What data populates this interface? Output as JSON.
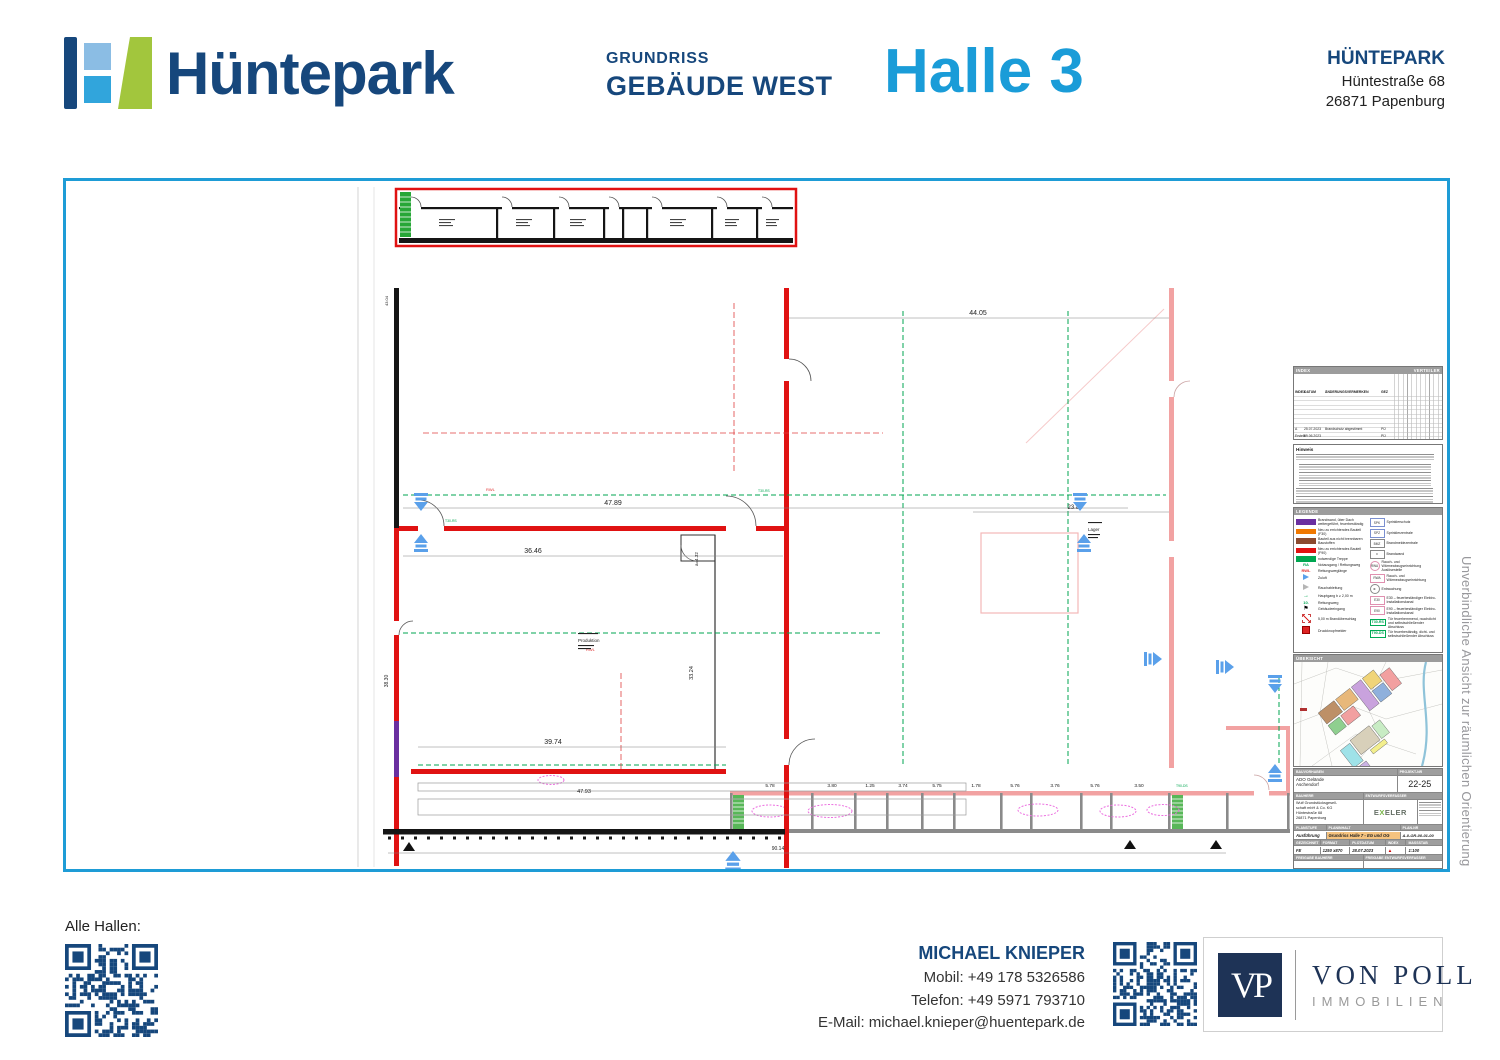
{
  "colors": {
    "brand_navy": "#16477c",
    "accent_blue": "#1a9cd8",
    "frame_blue": "#1e9cd6",
    "wall_red": "#e01212",
    "existing_pink": "#f2a2a2",
    "firewall_purple": "#6a2fa0",
    "escape_green": "#00a651"
  },
  "header": {
    "brand": "Hüntepark",
    "doc_type": "GRUNDRISS",
    "building": "GEBÄUDE WEST",
    "hall_title": "Halle 3",
    "company": "HÜNTEPARK",
    "street": "Hüntestraße 68",
    "city": "26871 Papenburg"
  },
  "side_note": "Unverbindliche Ansicht zur räumlichen Orientierung",
  "plan": {
    "dims": {
      "top": "47.89",
      "right_top": "44.05",
      "hall_width": "36.46",
      "right_mid": "23.86",
      "bottom_inner": "39.74",
      "bottom_outer": "47.93",
      "hall_height": "33.24",
      "left_height": "38.30",
      "gate": "a=4.32",
      "total_bottom": "90.14",
      "top_left": "43.04"
    },
    "strip_dims": [
      "5.78",
      "3.80",
      "1.25",
      "3.74",
      "5.75",
      "1.78",
      "5.76",
      "3.76",
      "5.76",
      "3.50"
    ],
    "rooms": {
      "production": "Produktion",
      "storage": "Lager"
    },
    "marks": {
      "rwl1": "RWL",
      "rwl2": "RWL",
      "door1": "T30-RS",
      "door2": "T30-RS",
      "door3": "T90-DS"
    }
  },
  "revision": {
    "index_header": "INDEX",
    "verteiler_header": "VERTEILER",
    "col_index": "INDEX",
    "col_datum": "DATUM",
    "col_vermerk": "ÄNDERUNGSVERMERKEN",
    "col_gez": "GEZ",
    "row_a": {
      "index": "A",
      "datum": "25.07.2023",
      "vermerk": "Brandschutz abgestimmt",
      "gez": "PÜ"
    },
    "row_erstellt": {
      "index": "Erstellt:",
      "datum": "09.06.2023",
      "vermerk": "",
      "gez": "PÜ"
    }
  },
  "notes": {
    "title": "Hinweis"
  },
  "legend": {
    "title": "LEGENDE",
    "left": [
      {
        "label": "Brandwand, über Dach weitergeführt, feuerbeständig"
      },
      {
        "label": "Neu zu errichtendes Bauteil (F30)"
      },
      {
        "label": "Bauteil aus nicht brennbaren Baustoffen"
      },
      {
        "label": "Neu zu errichtendes Bauteil (F90)"
      },
      {
        "label": "notwendige Treppe"
      },
      {
        "label": "Notausgang / Rettungsweg"
      },
      {
        "label": "Rettungsweglänge"
      },
      {
        "label": "Zuluft"
      },
      {
        "label": "Rauchableitung"
      },
      {
        "label": "Hauptgang b ≥ 2,00 m"
      },
      {
        "label": "Rettungsweg"
      },
      {
        "label": "Gebäudeeingang"
      },
      {
        "label": "5,00 m Brandüberschlag"
      },
      {
        "label": "Druckknopfmelder"
      }
    ],
    "right": [
      {
        "icon": "SPK",
        "label": "Sprinklerschutz"
      },
      {
        "icon": "SPZ",
        "label": "Sprinklerzentrale"
      },
      {
        "icon": "BMZ",
        "label": "Brandmeldezentrale"
      },
      {
        "icon": "≡",
        "label": "Brandwand"
      },
      {
        "icon": "RWA",
        "label": "Rauch- und Wärmeabzugseinrichtung Auslösestelle"
      },
      {
        "icon": "RWA",
        "label": "Rauch- und Wärmeabzugseinrichtung"
      },
      {
        "icon": "⊗",
        "label": "Entrauchung"
      },
      {
        "icon": "E30",
        "label": "E30 – feuerbeständiger Elektro-Installationskanal"
      },
      {
        "icon": "E90",
        "label": "E90 – feuerbeständiger Elektro-Installationskanal"
      },
      {
        "icon": "T30-RS",
        "label": "Tür feuerhemmend, rauchdicht und selbstschließender Abschluss"
      },
      {
        "icon": "T90-DS",
        "label": "Tür feuerbeständig, dicht- und selbstschließender Abschluss"
      }
    ]
  },
  "uebersicht": {
    "title": "ÜBERSICHT"
  },
  "titleblock": {
    "bauvorhaben_label": "BAUVORHABEN",
    "bauvorhaben_1": "ADO Gelände",
    "bauvorhaben_2": "Aschendorf",
    "projekt_label": "PROJEKT-NR",
    "projekt_nr": "22-25",
    "bauherr_label": "BAUHERR",
    "bauherr_1": "Wulf Grundstücksgesell-",
    "bauherr_2": "schaft mbH & Co. KG",
    "bauherr_3": "Hüntestraße 68",
    "bauherr_4": "26871 Papenburg",
    "entwurf_label": "ENTWURFSVERFASSER",
    "entwurf_firm_pre": "E",
    "entwurf_firm_x": "X",
    "entwurf_firm_post": "ELER",
    "planstufe_label": "PLANSTUFE",
    "planstufe": "Ausführung",
    "planinhalt_label": "PLANINHALT",
    "planinhalt": "Grundriss Halle 7 - EG und OG",
    "plannr_label": "PLAN-NR",
    "plannr": "A-0-GR-00-01-00",
    "gezeichnet_label": "GEZEICHNET",
    "gezeichnet": "FE",
    "format_label": "FORMAT",
    "format": "1250 x870",
    "plotdatum_label": "PLOTDATUM",
    "plotdatum": "28.07.2023",
    "index_label": "INDEX",
    "index": "▲",
    "massstab_label": "MASSSTAB",
    "massstab": "1:100",
    "freigabe1_label": "FREIGABE BAUHERR",
    "freigabe2_label": "FREIGABE ENTWURFSVERFASSER"
  },
  "footer": {
    "alle_hallen": "Alle Hallen:",
    "contact_name": "MICHAEL KNIEPER",
    "mobil": "Mobil: +49 178 5326586",
    "telefon": "Telefon: +49 5971 793710",
    "email": "E-Mail: michael.knieper@huentepark.de",
    "vonpoll_initials": "VP",
    "vonpoll_name": "VON POLL",
    "vonpoll_sub": "IMMOBILIEN"
  }
}
